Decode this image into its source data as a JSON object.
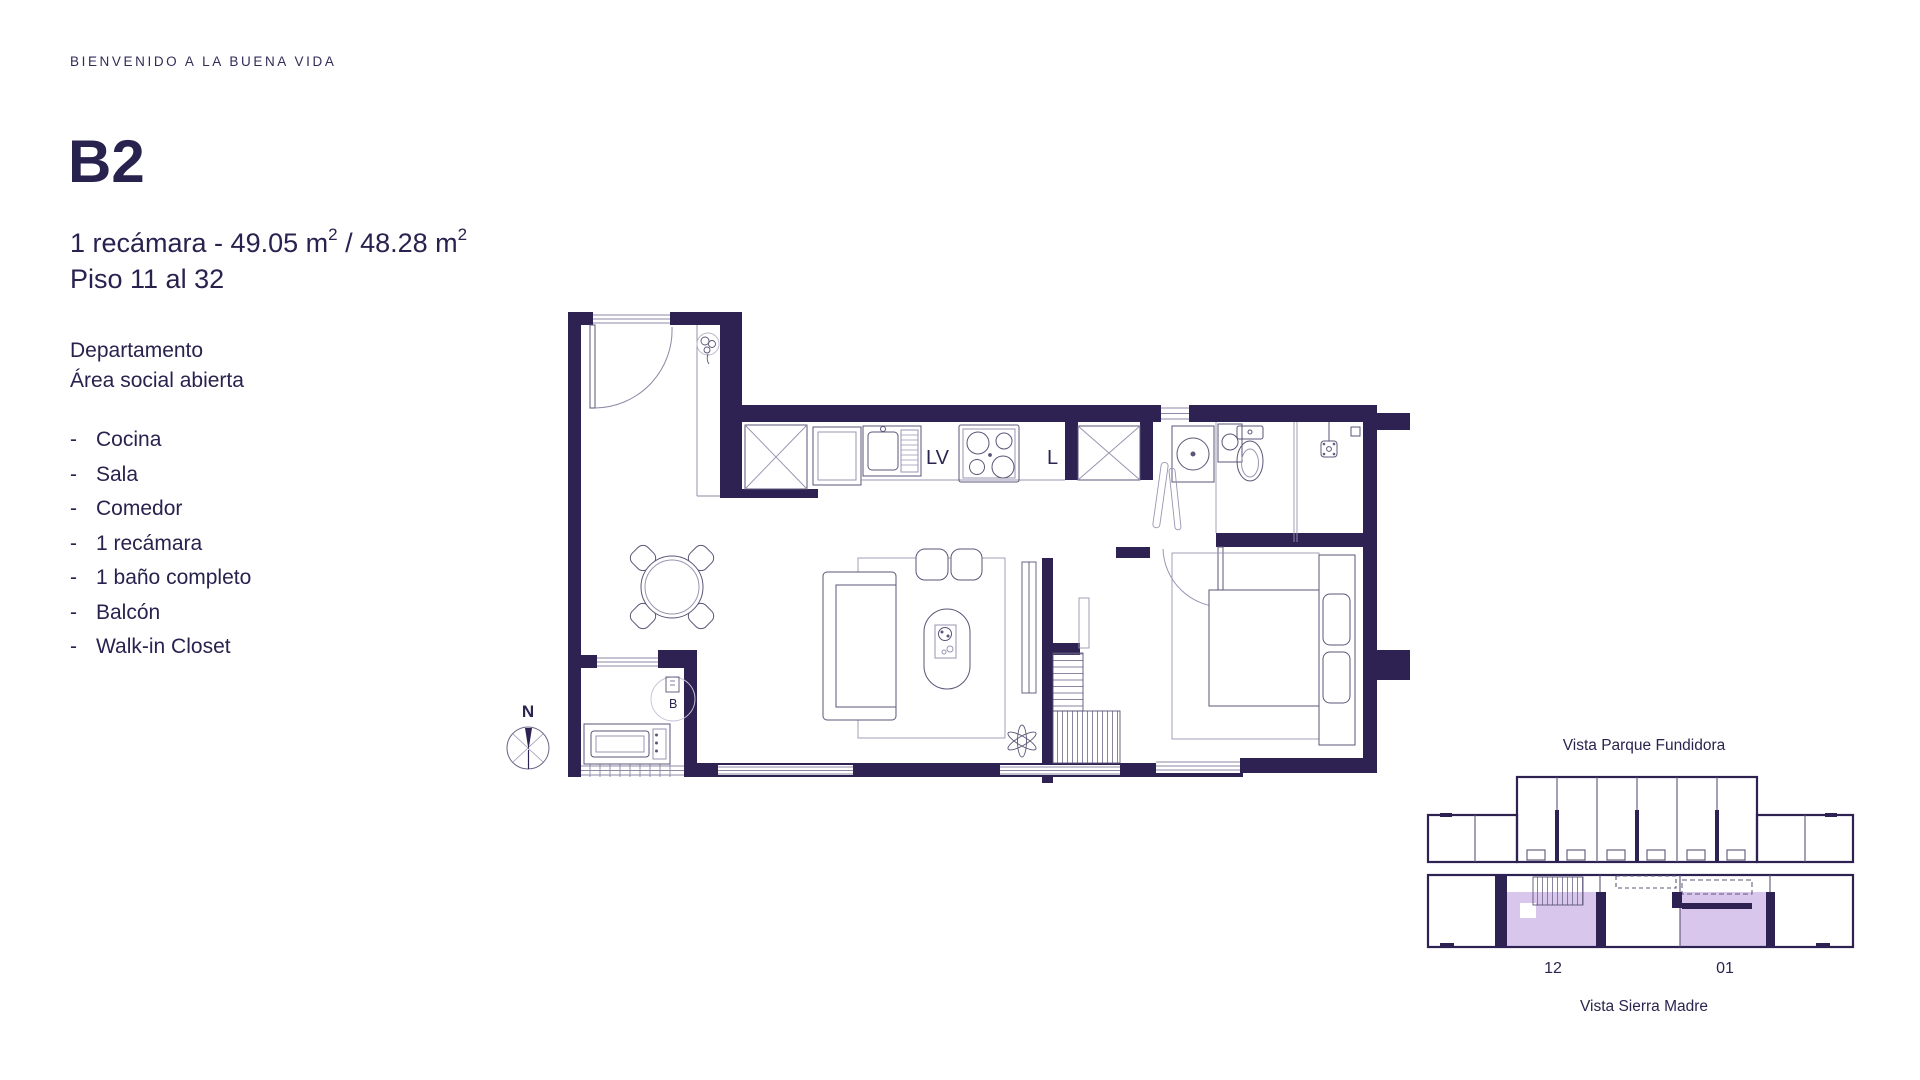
{
  "intro": {
    "welcome": "BIENVENIDO A LA BUENA VIDA"
  },
  "unit": {
    "code": "B2",
    "spec": {
      "part1": "1 recámara - 49.05 m",
      "sup1": "2",
      "part2": " / 48.28 m",
      "sup2": "2"
    },
    "floors": "Piso 11 al 32"
  },
  "description": {
    "line1": "Departamento",
    "line2": "Área social abierta"
  },
  "features": {
    "bullet": "-",
    "items": [
      "Cocina",
      "Sala",
      "Comedor",
      "1 recámara",
      "1 baño completo",
      "Balcón",
      "Walk-in Closet"
    ]
  },
  "floor_plan": {
    "labels": {
      "dishwasher": "LV",
      "washer": "L",
      "boiler": "B"
    },
    "compass": "N",
    "wall_color": "#2d2252",
    "line_color": "#5b5577"
  },
  "key_plan": {
    "top_label": "Vista Parque Fundidora",
    "bottom_label": "Vista Sierra Madre",
    "units": [
      "12",
      "01"
    ],
    "highlight_color": "#d8c6ec"
  }
}
